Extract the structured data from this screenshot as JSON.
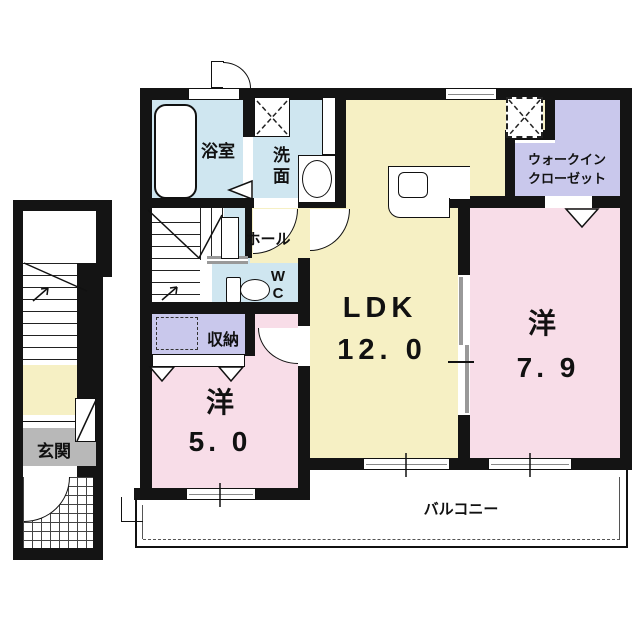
{
  "plan_title": "2F apartment floor plan",
  "colors": {
    "wall": "#141414",
    "wet_area_blue": "#cfe6f0",
    "ldk_yellow": "#f6f0c4",
    "closet_lavender": "#c9c8ec",
    "bedroom_pink": "#f8dde8",
    "genkan_gray": "#b8b8b8",
    "background": "#ffffff"
  },
  "rooms": {
    "bath": {
      "label": "浴室"
    },
    "washroom": {
      "label": "洗面"
    },
    "hall": {
      "label": "ホール"
    },
    "wc": {
      "label": "WC"
    },
    "storage": {
      "label": "収納"
    },
    "western5": {
      "label": "洋",
      "size": "5. 0"
    },
    "ldk": {
      "label": "LDK",
      "size": "12. 0"
    },
    "western79": {
      "label": "洋",
      "size": "7. 9"
    },
    "walk_in_closet": {
      "line1": "ウォークイン",
      "line2": "クローゼット"
    },
    "genkan": {
      "label": "玄関"
    },
    "balcony": {
      "label": "バルコニー"
    }
  },
  "fixtures": [
    "bathtub",
    "washer-pan",
    "vanity-sink",
    "toilet",
    "kitchen-counter-sink",
    "refrigerator-space",
    "staircase-1f",
    "staircase-2f",
    "entry-door",
    "door-arcs",
    "sliding-doors",
    "bifold-closet-doors",
    "balcony-windows"
  ]
}
